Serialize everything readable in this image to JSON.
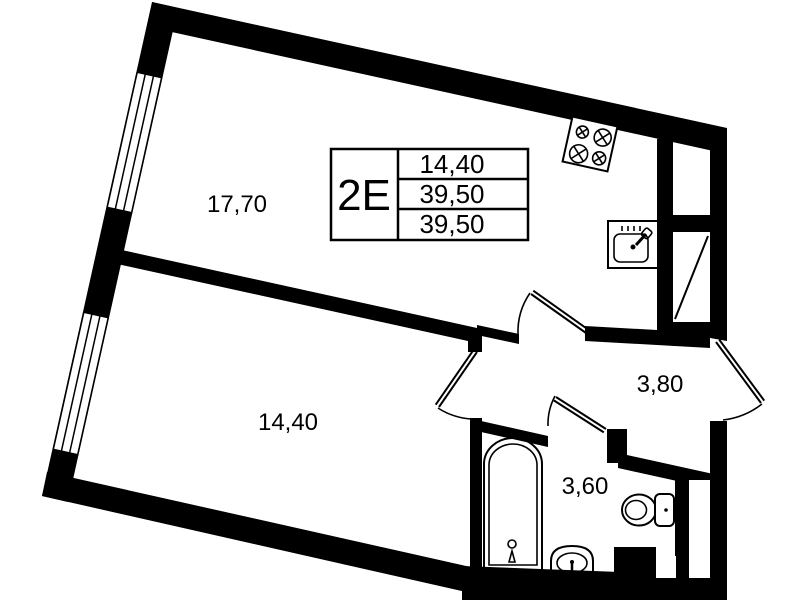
{
  "floorplan": {
    "unit": {
      "code": "2E",
      "row1": "14,40",
      "row2": "39,50",
      "row3": "39,50"
    },
    "rooms": {
      "living_area": "17,70",
      "bedroom_area": "14,40",
      "hall_area": "3,80",
      "bath_area": "3,60"
    },
    "colors": {
      "wall": "#000000",
      "background": "#ffffff"
    }
  }
}
